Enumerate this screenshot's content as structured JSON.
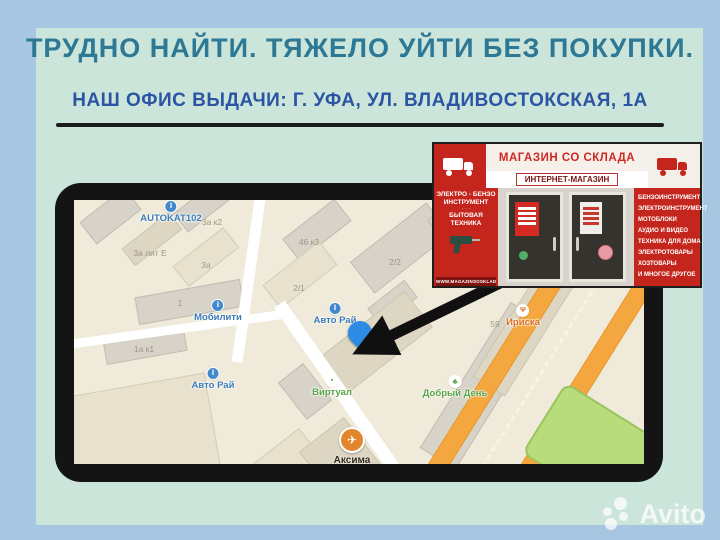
{
  "header": {
    "title": "ТРУДНО НАЙТИ. ТЯЖЕЛО УЙТИ БЕЗ ПОКУПКИ.",
    "subtitle": "НАШ ОФИС ВЫДАЧИ: Г. УФА, УЛ. ВЛАДИВОСТОКСКАЯ, 1А"
  },
  "colors": {
    "page_bg": "#a6c6e2",
    "card_bg": "#cbe5da",
    "title": "#2d7894",
    "subtitle": "#2b55a4",
    "photo_red": "#c4261d",
    "pin_blue": "#2e8be4",
    "highway_orange": "#f3a73e"
  },
  "map": {
    "pois": [
      {
        "label": "AUTOKAT102",
        "x": 97,
        "y": 1,
        "color": "#3b7ab8",
        "icon": "auto"
      },
      {
        "label": "Мобилити",
        "x": 144,
        "y": 100,
        "color": "#3b7ab8",
        "icon": "auto"
      },
      {
        "label": "Авто Рай",
        "x": 261,
        "y": 103,
        "color": "#3b7ab8",
        "icon": "auto"
      },
      {
        "label": "Авто Рай",
        "x": 139,
        "y": 168,
        "color": "#3b7ab8",
        "icon": "auto"
      },
      {
        "label": "Виртуал",
        "x": 258,
        "y": 175,
        "color": "#55a344",
        "icon": "shop"
      },
      {
        "label": "Добрый День",
        "x": 381,
        "y": 176,
        "color": "#55a344",
        "icon": "clover"
      },
      {
        "label": "Ириска",
        "x": 449,
        "y": 105,
        "color": "#d96a1e",
        "icon": "food"
      }
    ],
    "numbers": [
      {
        "text": "3а к2",
        "x": 138,
        "y": 17
      },
      {
        "text": "3а лит Е",
        "x": 76,
        "y": 48
      },
      {
        "text": "3а",
        "x": 132,
        "y": 60
      },
      {
        "text": "46 к3",
        "x": 235,
        "y": 37
      },
      {
        "text": "2/2",
        "x": 321,
        "y": 57
      },
      {
        "text": "2/1",
        "x": 225,
        "y": 83
      },
      {
        "text": "1",
        "x": 106,
        "y": 98
      },
      {
        "text": "1а к1",
        "x": 70,
        "y": 144
      },
      {
        "text": "59/1",
        "x": 316,
        "y": 131
      },
      {
        "text": "59",
        "x": 421,
        "y": 119
      },
      {
        "text": "55",
        "x": 209,
        "y": 277
      }
    ],
    "aksima": {
      "name": "Аксима",
      "line1": "Выгодные авиабилеты и туры!",
      "line2": "Звоните",
      "icon": "airplane"
    }
  },
  "photo": {
    "banner_title": "МАГАЗИН СО СКЛАДА",
    "banner_subtitle": "ИНТЕРНЕТ-МАГАЗИН",
    "left_panel": {
      "l1": "ЭЛЕКТРО - БЕНЗО",
      "l2": "ИНСТРУМЕНТ",
      "l3": "БЫТОВАЯ",
      "l4": "ТЕХНИКА",
      "site": "WWW.MAGAZINSOSKLADA.RU"
    },
    "right_panel": [
      "БЕНЗОИНСТРУМЕНТ",
      "ЭЛЕКТРОИНСТРУМЕНТ",
      "МОТОБЛОКИ",
      "АУДИО И ВИДЕО",
      "ТЕХНИКА ДЛЯ ДОМА",
      "ЭЛЕКТРОТОВАРЫ",
      "ХОЗТОВАРЫ",
      "И МНОГОЕ ДРУГОЕ"
    ]
  },
  "watermark": {
    "text": "Avito"
  }
}
